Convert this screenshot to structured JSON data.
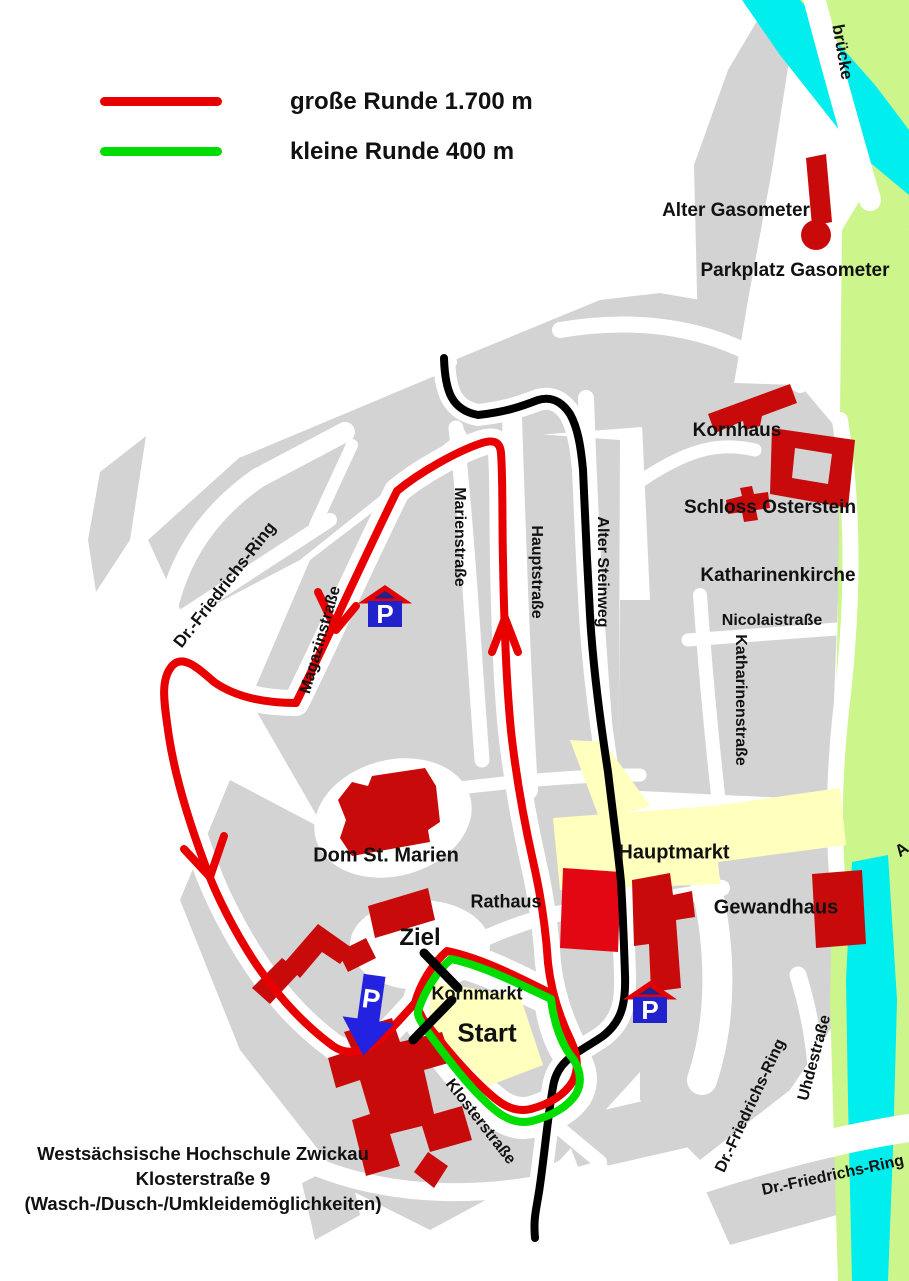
{
  "legend": {
    "items": [
      {
        "name": "grosse-runde",
        "label": "große Runde 1.700 m",
        "color": "#e80000"
      },
      {
        "name": "kleine-runde",
        "label": "kleine Runde 400 m",
        "color": "#00dd00"
      }
    ]
  },
  "routes": {
    "grosse_runde": {
      "label": "große Runde 1.700 m",
      "color": "#e80000"
    },
    "kleine_runde": {
      "label": "kleine Runde 400 m",
      "color": "#00dd00"
    },
    "connection": {
      "color": "#000000"
    }
  },
  "markers": {
    "ziel_label": "Ziel",
    "start_label": "Start",
    "parking_letter": "P"
  },
  "colors": {
    "city_block": "#d3d3d3",
    "market_square": "#ffffbe",
    "river": "#00eeee",
    "park": "#ccf58c",
    "building": "#c90a0a",
    "building_highlight": "#e30613",
    "parking_blue": "#2222cc",
    "arrow_blue": "#2222e0"
  },
  "footer": {
    "line1": "Westsächsische Hochschule Zwickau",
    "line2": "Klosterstraße 9",
    "line3": "(Wasch-/Dusch-/Umkleidemöglichkeiten)"
  },
  "labels": [
    {
      "name": "label-bruecke",
      "text": "brücke",
      "x": 842,
      "y": 52,
      "rot": 80,
      "size": 17
    },
    {
      "name": "label-alter-gasometer",
      "text": "Alter Gasometer",
      "x": 736,
      "y": 211,
      "rot": 0,
      "size": 19
    },
    {
      "name": "label-parkplatz-gasometer",
      "text": "Parkplatz Gasometer",
      "x": 795,
      "y": 271,
      "rot": 0,
      "size": 19
    },
    {
      "name": "label-kornhaus",
      "text": "Kornhaus",
      "x": 737,
      "y": 431,
      "rot": 0,
      "size": 19
    },
    {
      "name": "label-schloss-osterstein",
      "text": "Schloss Osterstein",
      "x": 770,
      "y": 508,
      "rot": 0,
      "size": 19
    },
    {
      "name": "label-katharinenkirche",
      "text": "Katharinenkirche",
      "x": 778,
      "y": 576,
      "rot": 0,
      "size": 19
    },
    {
      "name": "label-nicolaistrasse",
      "text": "Nicolaistraße",
      "x": 772,
      "y": 621,
      "rot": 0,
      "size": 16
    },
    {
      "name": "label-katharinenstrasse",
      "text": "Katharinenstraße",
      "x": 740,
      "y": 700,
      "rot": 90,
      "size": 16
    },
    {
      "name": "label-marienstrasse",
      "text": "Marienstraße",
      "x": 459,
      "y": 537,
      "rot": 90,
      "size": 16
    },
    {
      "name": "label-hauptstrasse",
      "text": "Hauptstraße",
      "x": 536,
      "y": 572,
      "rot": 90,
      "size": 16
    },
    {
      "name": "label-alter-steinweg",
      "text": "Alter Steinweg",
      "x": 602,
      "y": 572,
      "rot": 90,
      "size": 16
    },
    {
      "name": "label-magazinstrasse",
      "text": "Magazinstraße",
      "x": 321,
      "y": 640,
      "rot": -74,
      "size": 16
    },
    {
      "name": "label-dr-friedrichs-ring-nw",
      "text": "Dr.-Friedrichs-Ring",
      "x": 225,
      "y": 585,
      "rot": -52,
      "size": 17
    },
    {
      "name": "label-dom-st-marien",
      "text": "Dom St. Marien",
      "x": 386,
      "y": 856,
      "rot": 0,
      "size": 20
    },
    {
      "name": "label-hauptmarkt",
      "text": "Hauptmarkt",
      "x": 674,
      "y": 853,
      "rot": 0,
      "size": 20
    },
    {
      "name": "label-rathaus",
      "text": "Rathaus",
      "x": 506,
      "y": 902,
      "rot": 0,
      "size": 18
    },
    {
      "name": "label-gewandhaus",
      "text": "Gewandhaus",
      "x": 776,
      "y": 908,
      "rot": 0,
      "size": 20
    },
    {
      "name": "label-ziel",
      "text": "Ziel",
      "x": 420,
      "y": 938,
      "rot": 0,
      "size": 24
    },
    {
      "name": "label-kornmarkt",
      "text": "Kornmarkt",
      "x": 477,
      "y": 994,
      "rot": 0,
      "size": 18
    },
    {
      "name": "label-start",
      "text": "Start",
      "x": 487,
      "y": 1033,
      "rot": 0,
      "size": 26
    },
    {
      "name": "label-klosterstrasse",
      "text": "Klosterstraße",
      "x": 480,
      "y": 1122,
      "rot": 52,
      "size": 16
    },
    {
      "name": "label-uhdestrasse",
      "text": "Uhdestraße",
      "x": 815,
      "y": 1058,
      "rot": -75,
      "size": 16
    },
    {
      "name": "label-dr-friedrichs-ring-se",
      "text": "Dr.-Friedrichs-Ring",
      "x": 751,
      "y": 1106,
      "rot": -65,
      "size": 16
    },
    {
      "name": "label-dr-friedrichs-ring-s",
      "text": "Dr.-Friedrichs-Ring",
      "x": 833,
      "y": 1176,
      "rot": -12,
      "size": 16
    },
    {
      "name": "label-cut-off-a",
      "text": "A",
      "x": 902,
      "y": 850,
      "rot": -35,
      "size": 17
    }
  ]
}
